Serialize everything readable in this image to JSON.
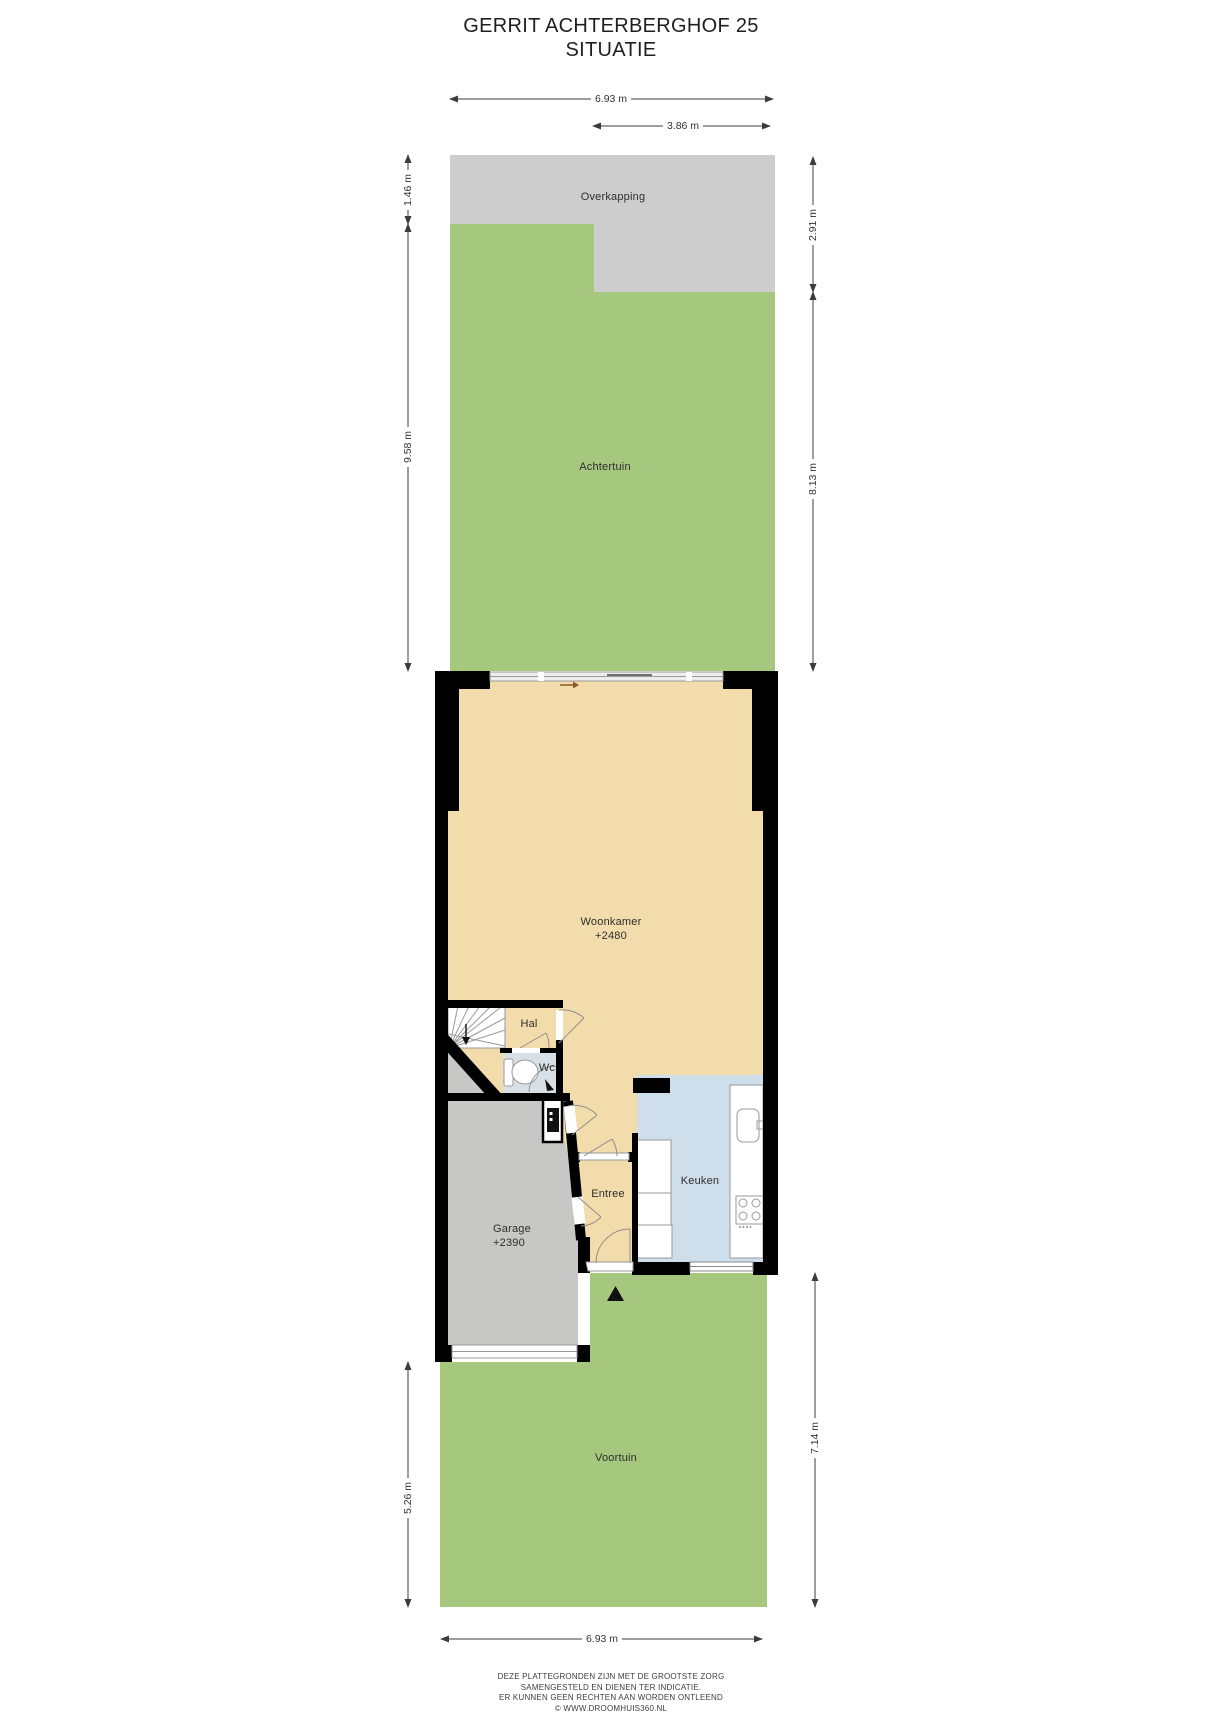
{
  "title": {
    "line1": "GERRIT ACHTERBERGHOF 25",
    "line2": "SITUATIE"
  },
  "rooms": {
    "overkapping": {
      "label": "Overkapping"
    },
    "achtertuin": {
      "label": "Achtertuin"
    },
    "woonkamer": {
      "label": "Woonkamer",
      "level": "+2480"
    },
    "hal": {
      "label": "Hal"
    },
    "wc": {
      "label": "Wc"
    },
    "entree": {
      "label": "Entree"
    },
    "keuken": {
      "label": "Keuken"
    },
    "garage": {
      "label": "Garage",
      "level": "+2390"
    },
    "voortuin": {
      "label": "Voortuin"
    }
  },
  "dimensions": {
    "top_total_width": "6.93 m",
    "overkapping_width": "3.86 m",
    "overkapping_depth_left": "1.46 m",
    "back_garden_depth_left": "9.58 m",
    "overkapping_depth_right": "2.91 m",
    "back_garden_depth_right": "8.13 m",
    "front_garden_depth_left": "5.26 m",
    "front_garden_depth_right": "7.14 m",
    "bottom_total_width": "6.93 m"
  },
  "footer": {
    "lines": [
      "DEZE PLATTEGRONDEN ZIJN MET DE GROOTSTE ZORG",
      "SAMENGESTELD EN DIENEN TER INDICATIE.",
      "ER KUNNEN GEEN RECHTEN AAN WORDEN ONTLEEND",
      "© WWW.DROOMHUIS360.NL"
    ]
  },
  "icons": {
    "entrance_marker": "black triangle pointing up at front door",
    "stairs": "winder staircase with direction arrow",
    "toilet": "wc pan with cistern",
    "sink": "kitchen sink with tap",
    "stove": "4-burner cooktop",
    "sliding_door_arrow": "slide direction arrow",
    "door_swing": "quarter-circle door arcs"
  },
  "colors": {
    "garden_green": "#a6c87e",
    "overkapping_gray": "#cdcdcd",
    "garage_gray": "#c7c7c6",
    "floor_beige": "#f2dcab",
    "keuken_blue": "#cfdeeb",
    "wc_gray": "#d8e0e5",
    "wall_black": "#000000"
  }
}
